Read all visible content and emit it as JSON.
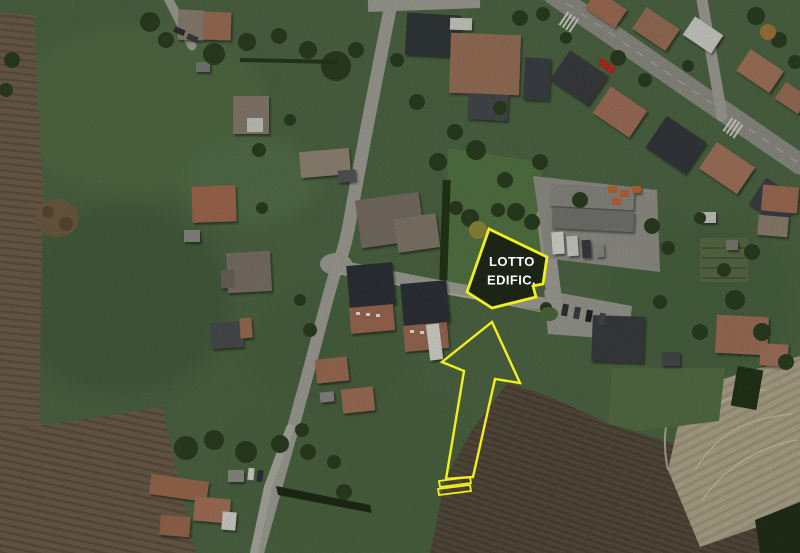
{
  "image": {
    "kind": "aerial-satellite-photo",
    "features": [
      "green-meadows",
      "plowed-fields",
      "village-houses",
      "main-road",
      "industrial-yard",
      "farmstead",
      "building-lot"
    ]
  },
  "annotation": {
    "lot_label": {
      "line1": "LOTTO",
      "line2": "EDIFIC.",
      "text_color": "#ffffff",
      "box_fill": "#1b2415",
      "outline_color": "#f3ef1d"
    },
    "arrow": {
      "outline_color": "#f3ef1d"
    }
  },
  "palette": {
    "meadow_green": "#4e6744",
    "lawn_green": "#547544",
    "plowed_brown": "#6d5e4a",
    "dark_brown": "#584d3f",
    "tan_field": "#b1a78d",
    "road_grey": "#a0a098",
    "terracotta_roof": "#a1705a",
    "dark_roof": "#33373a"
  }
}
